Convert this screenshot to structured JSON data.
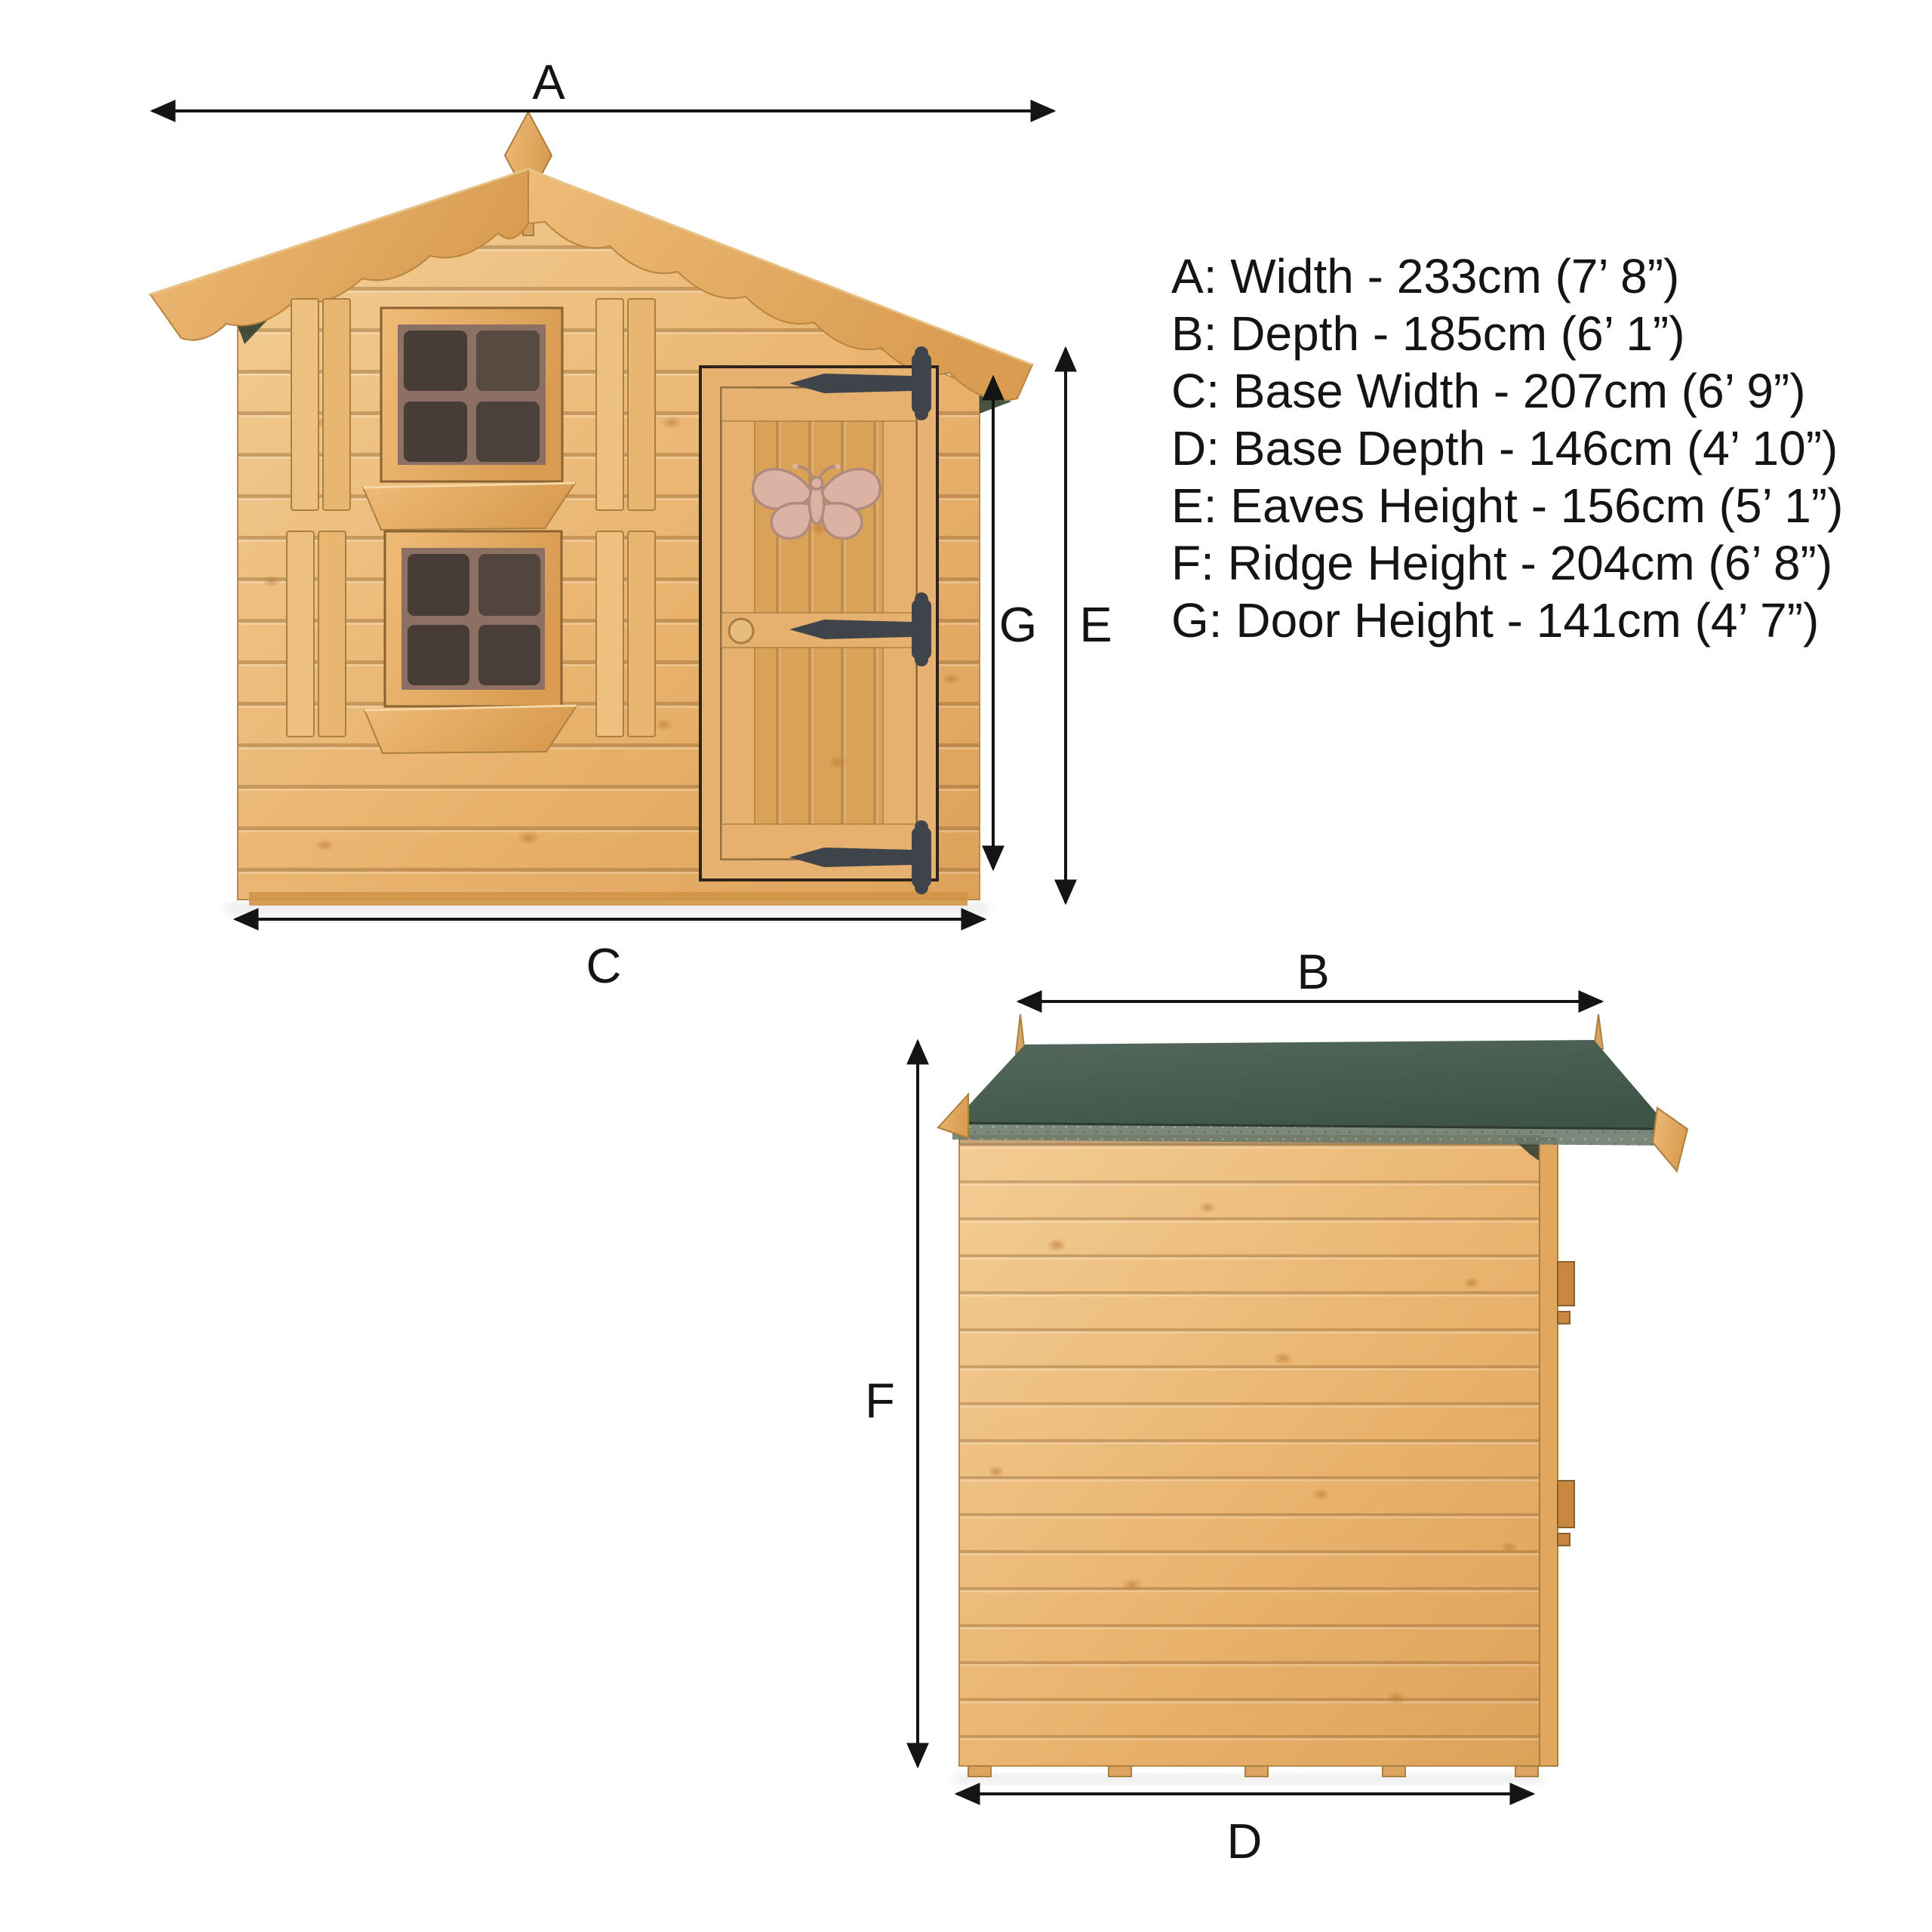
{
  "page": {
    "background": "#ffffff"
  },
  "legend": {
    "items": [
      {
        "letter": "A",
        "text": "A: Width - 233cm (7’ 8”)"
      },
      {
        "letter": "B",
        "text": "B: Depth - 185cm (6’ 1”)"
      },
      {
        "letter": "C",
        "text": "C: Base Width - 207cm (6’ 9”)"
      },
      {
        "letter": "D",
        "text": "D: Base Depth - 146cm (4’ 10”)"
      },
      {
        "letter": "E",
        "text": "E: Eaves Height - 156cm (5’ 1”)"
      },
      {
        "letter": "F",
        "text": "F: Ridge Height - 204cm (6’ 8”)"
      },
      {
        "letter": "G",
        "text": "G: Door Height - 141cm (4’ 7”)"
      }
    ]
  },
  "colors": {
    "line": "#141414",
    "wood": "#e8b26c",
    "wood_light": "#f3cd95",
    "wood_shadow": "#c08744",
    "plank_line": "#8a5f2e",
    "roof_felt": "#47604e",
    "roof_felt_edge": "#6c7b6d",
    "window_pane": "#473c36",
    "window_mullion": "#8d7064",
    "butterfly": "#dcb2a4",
    "hinge": "#3e444a"
  }
}
